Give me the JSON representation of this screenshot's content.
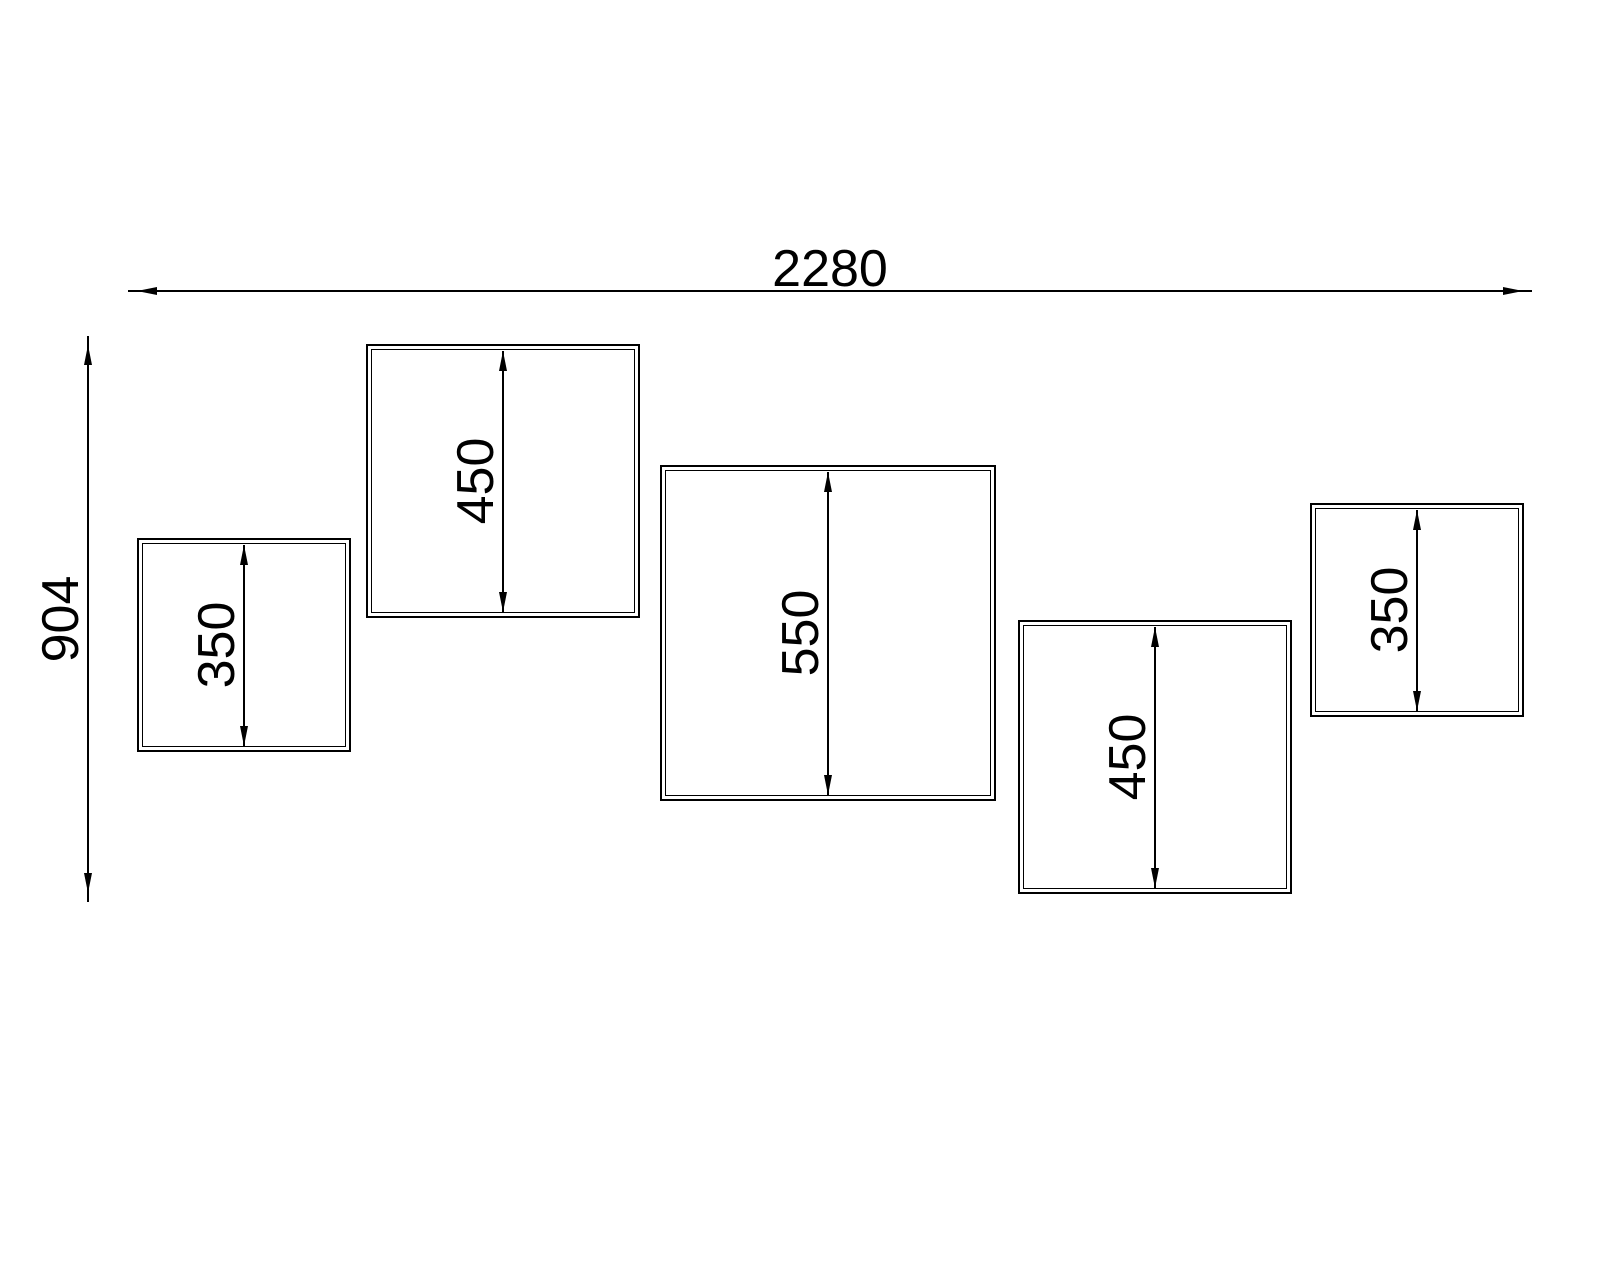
{
  "drawing": {
    "type": "technical-elevation",
    "overall": {
      "width_label": "2280",
      "height_label": "904"
    },
    "panels": [
      {
        "height_label": "350"
      },
      {
        "height_label": "450"
      },
      {
        "height_label": "550"
      },
      {
        "height_label": "450"
      },
      {
        "height_label": "350"
      }
    ]
  },
  "colors": {
    "line": "#000000",
    "background": "#ffffff",
    "text": "#000000"
  }
}
